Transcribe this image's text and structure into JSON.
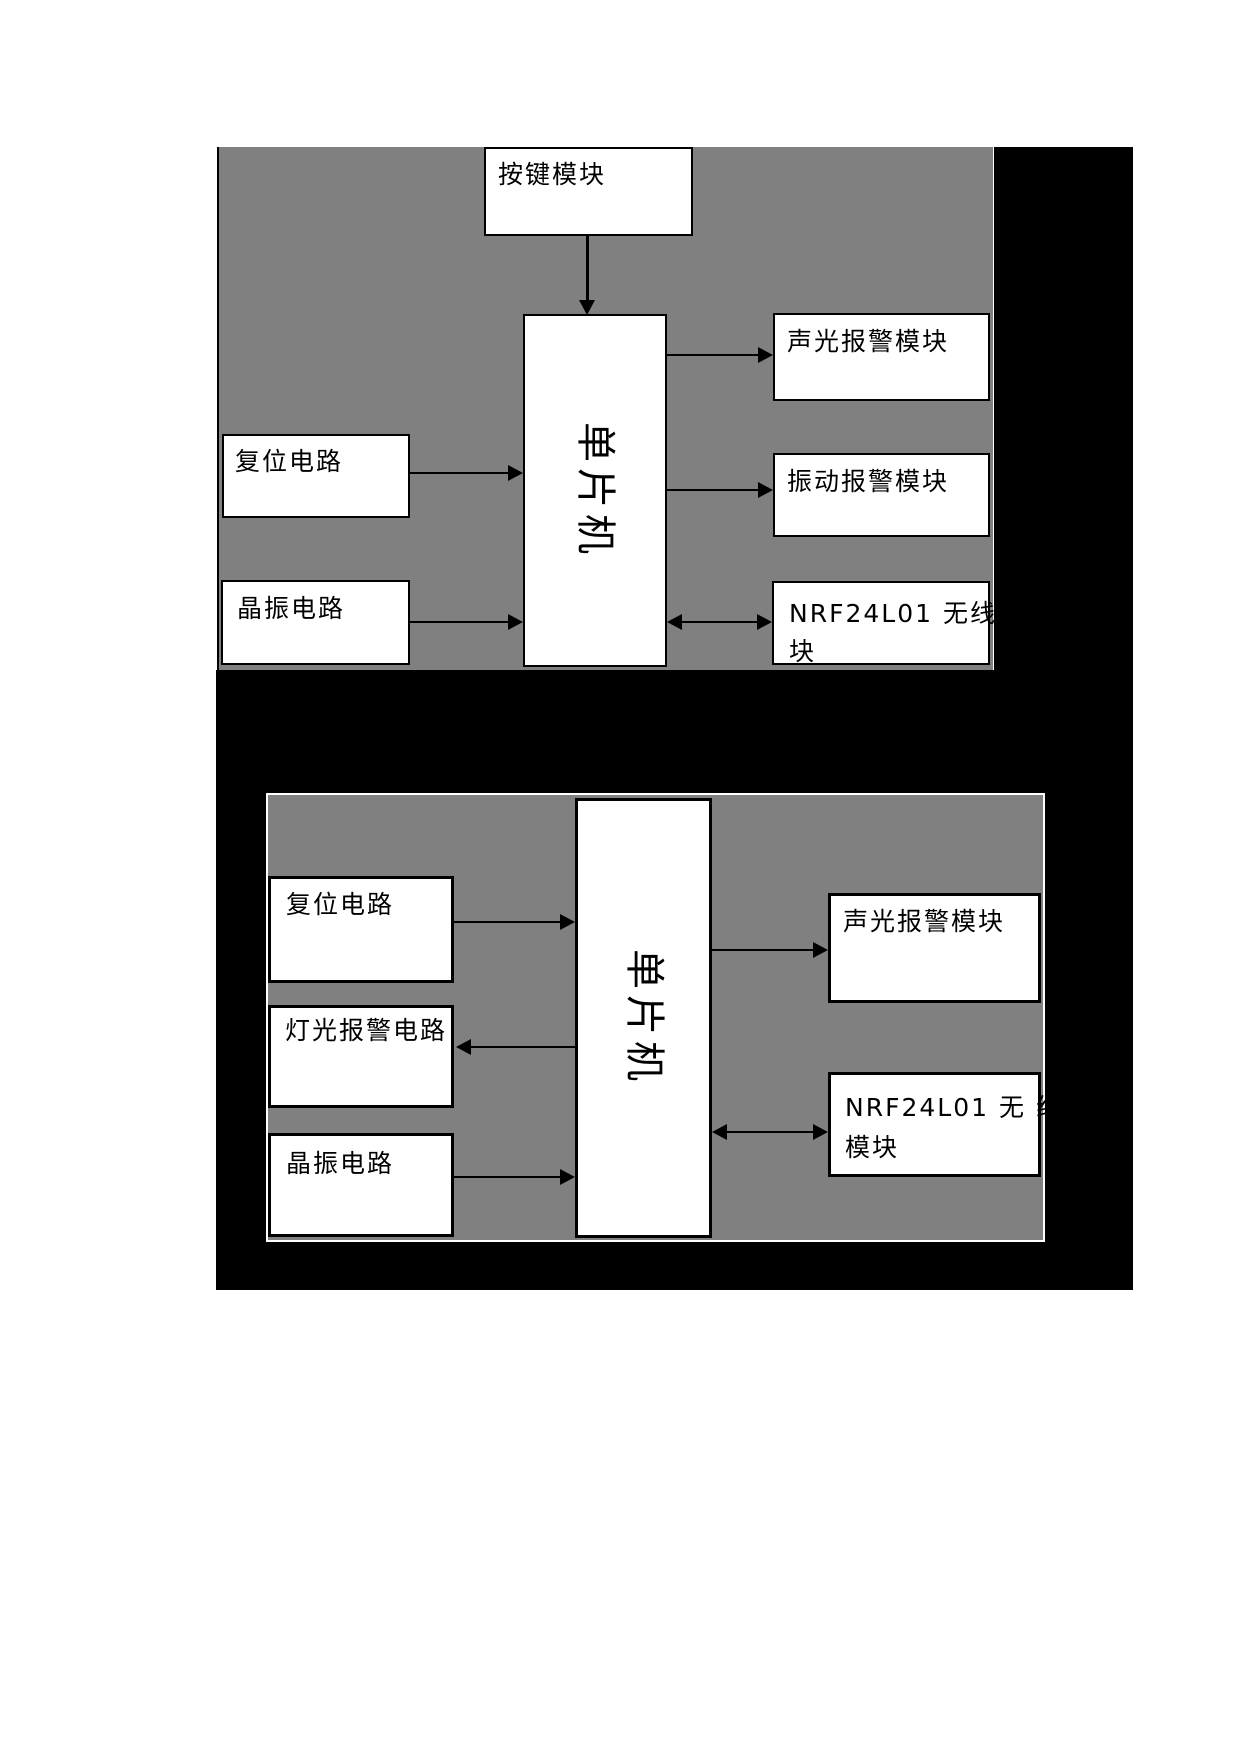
{
  "colors": {
    "panel_gray": "#808080",
    "ink_black": "#000000",
    "box_white": "#ffffff",
    "bottom_panel_outline": "#ffffff"
  },
  "top_diagram": {
    "boxes": {
      "key_module": {
        "label": "按键模块"
      },
      "reset_circuit": {
        "label": "复位电路"
      },
      "crystal_circuit": {
        "label": "晶振电路"
      },
      "mcu": {
        "label": "单片机"
      },
      "sound_light_alarm": {
        "label": "声光报警模块"
      },
      "vibration_alarm": {
        "label": "振动报警模块"
      },
      "nrf_module": {
        "lines": [
          "NRF24L01 无线模",
          "块"
        ]
      }
    }
  },
  "bottom_diagram": {
    "boxes": {
      "reset_circuit": {
        "label": "复位电路"
      },
      "light_alarm_circuit": {
        "label": "灯光报警电路"
      },
      "crystal_circuit": {
        "label": "晶振电路"
      },
      "mcu": {
        "label": "单片机"
      },
      "sound_light_alarm": {
        "label": "声光报警模块"
      },
      "nrf_module": {
        "lines": [
          "NRF24L01  无 线",
          "模块"
        ]
      }
    }
  }
}
